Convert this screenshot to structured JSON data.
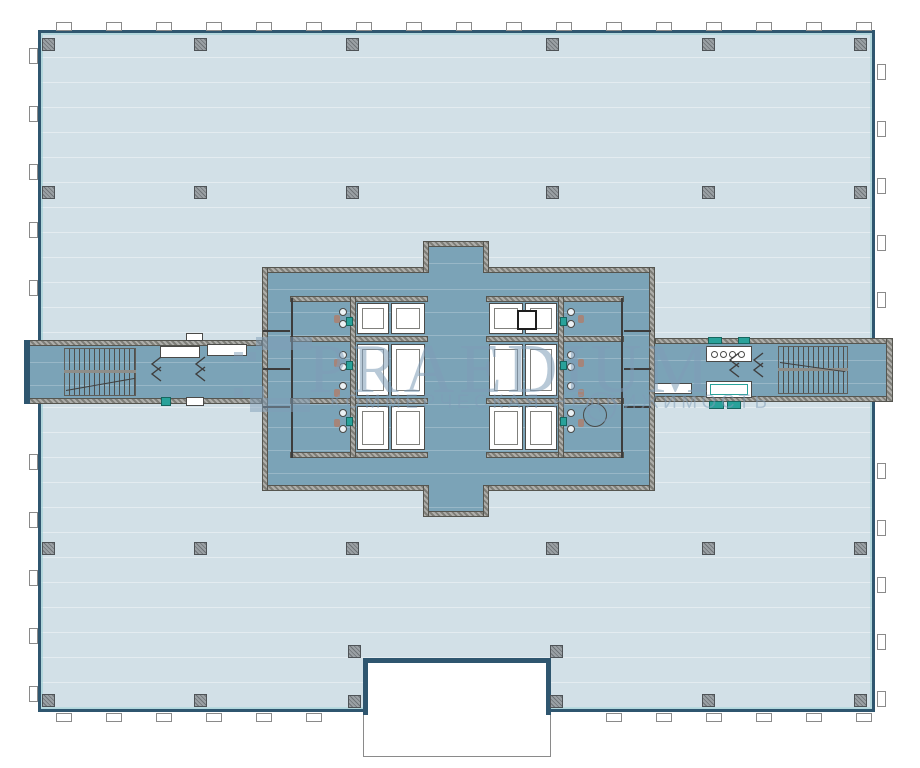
{
  "watermark": {
    "brand": "PRAEDIUM",
    "subtitle": "КОММЕРЧЕСКАЯ НЕДВИЖИМОСТЬ"
  },
  "colors": {
    "floor": "#d2e0e7",
    "core": "#7ba3b7",
    "outer_wall": "#2f566f",
    "hatch_light": "#aeaeaa",
    "hatch_dark": "#7e7e78",
    "column": "#8f9499",
    "teal_accent": "#29a29a",
    "fixture_white": "#ffffff",
    "line_dark": "#4a4a48",
    "watermark": "#7f9db8",
    "brown_fixture": "#a5857a"
  },
  "plan": {
    "building": [
      38,
      30,
      837,
      682
    ],
    "notch": {
      "body": [
        363,
        661,
        188,
        96
      ],
      "top_wall": [
        363,
        658,
        188,
        5
      ],
      "side_walls": [
        [
          363,
          661,
          5,
          54
        ],
        [
          546,
          661,
          5,
          54
        ]
      ]
    },
    "column_size": 13,
    "columns": [
      [
        48,
        44
      ],
      [
        200,
        44
      ],
      [
        352,
        44
      ],
      [
        552,
        44
      ],
      [
        708,
        44
      ],
      [
        860,
        44
      ],
      [
        48,
        192
      ],
      [
        200,
        192
      ],
      [
        352,
        192
      ],
      [
        552,
        192
      ],
      [
        708,
        192
      ],
      [
        860,
        192
      ],
      [
        48,
        548
      ],
      [
        200,
        548
      ],
      [
        352,
        548
      ],
      [
        552,
        548
      ],
      [
        708,
        548
      ],
      [
        860,
        548
      ],
      [
        48,
        700
      ],
      [
        200,
        700
      ],
      [
        708,
        700
      ],
      [
        860,
        700
      ],
      [
        354,
        651
      ],
      [
        556,
        651
      ],
      [
        354,
        701
      ],
      [
        556,
        701
      ]
    ],
    "mullions": {
      "top": {
        "axis": "x",
        "fixed": 22,
        "from": 56,
        "to": 856,
        "step": 50,
        "w": 16,
        "h": 9,
        "skip": null
      },
      "bottom": {
        "axis": "x",
        "fixed": 713,
        "from": 56,
        "to": 856,
        "step": 50,
        "w": 16,
        "h": 9,
        "skip": [
          348,
          562
        ]
      },
      "left": {
        "axis": "y",
        "fixed": 29,
        "from": 48,
        "to": 690,
        "step": 58,
        "w": 9,
        "h": 16,
        "skip": [
          318,
          432
        ]
      },
      "right": {
        "axis": "y",
        "fixed": 877,
        "from": 64,
        "to": 695,
        "step": 57,
        "w": 9,
        "h": 16,
        "skip": [
          318,
          432
        ]
      }
    },
    "core": {
      "fills": [
        [
          262,
          267,
          393,
          224
        ],
        [
          423,
          241,
          66,
          30
        ],
        [
          423,
          485,
          66,
          32
        ]
      ],
      "walls": [
        [
          262,
          267,
          167,
          6
        ],
        [
          483,
          267,
          172,
          6
        ],
        [
          423,
          241,
          66,
          6
        ],
        [
          423,
          241,
          6,
          32
        ],
        [
          483,
          241,
          6,
          32
        ],
        [
          262,
          485,
          167,
          6
        ],
        [
          483,
          485,
          172,
          6
        ],
        [
          423,
          511,
          66,
          6
        ],
        [
          423,
          485,
          6,
          32
        ],
        [
          483,
          485,
          6,
          32
        ],
        [
          262,
          267,
          6,
          224
        ],
        [
          649,
          267,
          6,
          224
        ],
        [
          290,
          296,
          138,
          6
        ],
        [
          290,
          336,
          138,
          6
        ],
        [
          290,
          398,
          138,
          6
        ],
        [
          290,
          452,
          138,
          6
        ],
        [
          486,
          296,
          138,
          6
        ],
        [
          486,
          336,
          138,
          6
        ],
        [
          486,
          398,
          138,
          6
        ],
        [
          486,
          452,
          138,
          6
        ],
        [
          350,
          296,
          6,
          162
        ],
        [
          558,
          296,
          6,
          162
        ]
      ],
      "dark_lines": [
        [
          291,
          298,
          2,
          160
        ],
        [
          621,
          298,
          2,
          160
        ],
        [
          263,
          330,
          27,
          2
        ],
        [
          263,
          368,
          27,
          2
        ],
        [
          263,
          406,
          27,
          2
        ],
        [
          624,
          330,
          27,
          2
        ],
        [
          624,
          368,
          27,
          2
        ],
        [
          624,
          406,
          27,
          2
        ]
      ],
      "cells": [
        [
          357,
          303,
          32,
          31
        ],
        [
          391,
          303,
          34,
          31
        ],
        [
          357,
          344,
          32,
          52
        ],
        [
          391,
          344,
          34,
          52
        ],
        [
          357,
          406,
          32,
          44
        ],
        [
          391,
          406,
          34,
          44
        ],
        [
          489,
          303,
          34,
          31
        ],
        [
          525,
          303,
          32,
          31
        ],
        [
          489,
          344,
          34,
          52
        ],
        [
          525,
          344,
          32,
          52
        ],
        [
          489,
          406,
          34,
          44
        ],
        [
          525,
          406,
          32,
          44
        ]
      ],
      "circles": {
        "r": 4,
        "x_left": 343,
        "x_right": 571,
        "ys": [
          312,
          324,
          355,
          367,
          386,
          413,
          429
        ]
      },
      "brown_dots": {
        "w": 6,
        "h": 8,
        "x_left": 334,
        "x_right": 578,
        "ys": [
          315,
          359,
          389,
          419
        ]
      },
      "teal_marks": [
        [
          346,
          317
        ],
        [
          346,
          361
        ],
        [
          346,
          417
        ],
        [
          560,
          317
        ],
        [
          560,
          361
        ],
        [
          560,
          417
        ]
      ],
      "teal_size": [
        7,
        9
      ],
      "dark_square": [
        517,
        310,
        20,
        20
      ],
      "big_circle": {
        "cx": 595,
        "cy": 415,
        "r": 12
      }
    },
    "wings": {
      "left": {
        "fill": [
          24,
          340,
          238,
          64
        ],
        "walls": [
          [
            24,
            340,
            238,
            6
          ],
          [
            24,
            398,
            238,
            6
          ]
        ],
        "end_wall": [
          24,
          340,
          6,
          64
        ],
        "stairs": {
          "box": [
            64,
            348,
            72,
            48
          ],
          "midbar": [
            64,
            370,
            72,
            3
          ],
          "diag": [
            66,
            390,
            70,
            -10
          ]
        },
        "whites": [
          [
            160,
            346,
            40,
            12
          ],
          [
            207,
            344,
            40,
            12
          ],
          [
            186,
            333,
            17,
            8
          ],
          [
            186,
            397,
            18,
            9
          ]
        ],
        "teals": [
          [
            161,
            397,
            10,
            9
          ]
        ],
        "chevrons": [
          [
            150,
            356
          ],
          [
            194,
            356
          ]
        ]
      },
      "right": {
        "fill": [
          655,
          338,
          238,
          64
        ],
        "walls": [
          [
            655,
            338,
            238,
            6
          ],
          [
            655,
            396,
            238,
            6
          ]
        ],
        "end_wall": [
          886,
          338,
          7,
          64
        ],
        "stairs": {
          "box": [
            778,
            346,
            70,
            48
          ],
          "midbar": [
            778,
            368,
            70,
            3
          ],
          "diag": [
            780,
            362,
            66,
            8
          ]
        },
        "whites": [
          [
            706,
            346,
            46,
            16
          ],
          [
            652,
            383,
            40,
            11
          ],
          [
            706,
            381,
            46,
            17
          ]
        ],
        "teal_inner": [
          710,
          384,
          38,
          11
        ],
        "teals": [
          [
            708,
            337,
            14,
            7
          ],
          [
            738,
            337,
            12,
            7
          ],
          [
            709,
            401,
            15,
            8
          ],
          [
            727,
            401,
            14,
            8
          ]
        ],
        "room_circles": {
          "y": 354,
          "r": 3.5,
          "xs": [
            714,
            723,
            732,
            741
          ]
        },
        "chevrons": [
          [
            728,
            352
          ],
          [
            752,
            352
          ]
        ]
      }
    }
  }
}
